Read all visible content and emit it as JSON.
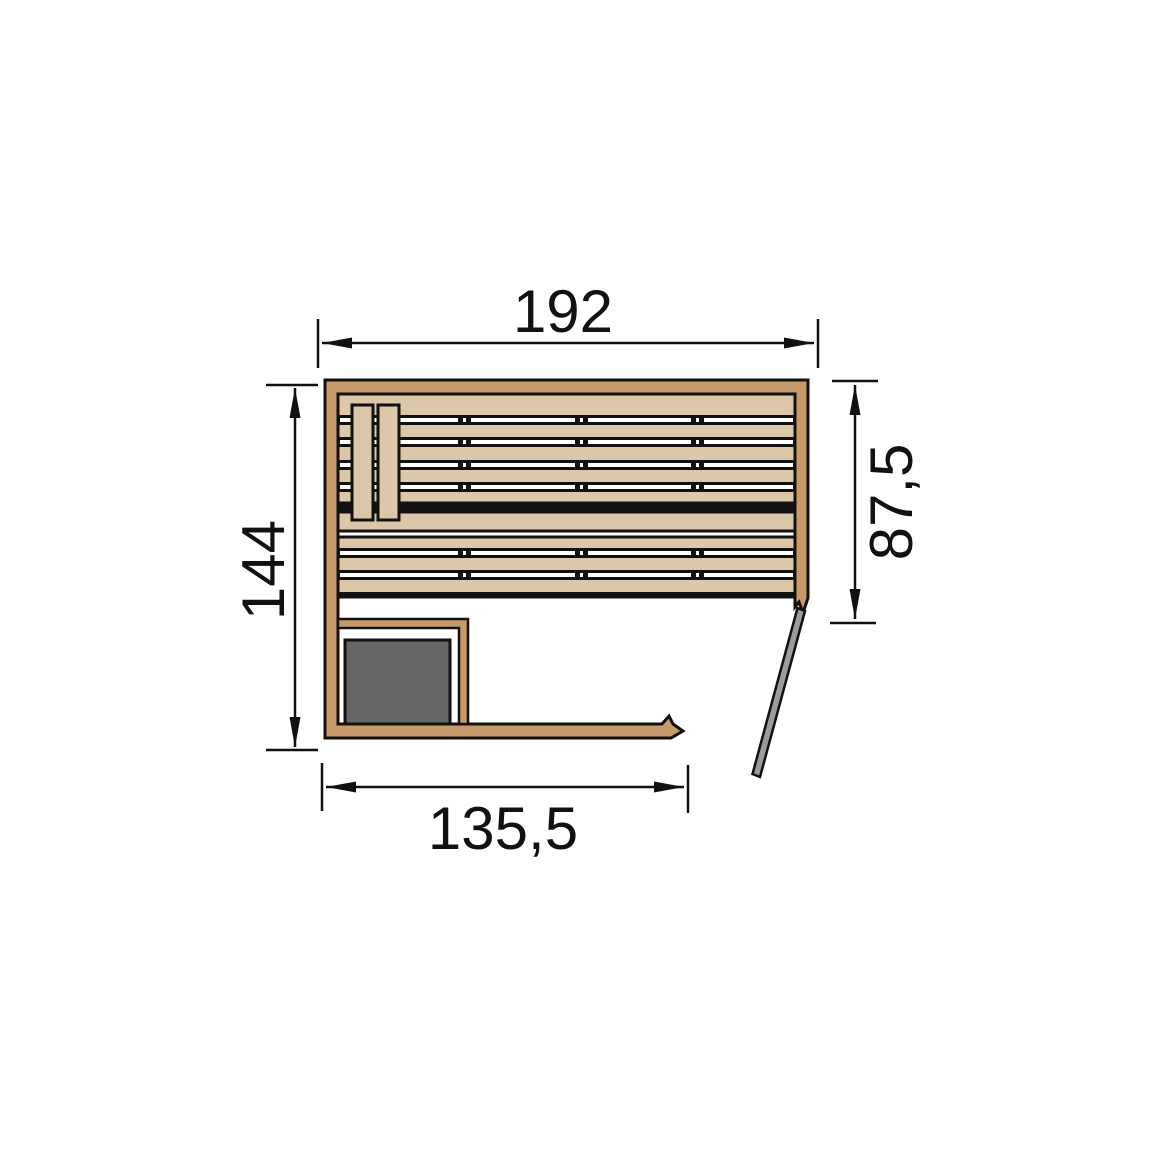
{
  "diagram": {
    "title": "sauna-floor-plan",
    "dimensions": {
      "top_width": {
        "label": "192"
      },
      "left_height": {
        "label": "144"
      },
      "right_side": {
        "label": "87,5"
      },
      "bottom_front": {
        "label": "135,5"
      }
    },
    "colors": {
      "wall": "#c69a6a",
      "bench": "#dcc7a8",
      "heater": "#666666",
      "door": "#9b9b9b",
      "line": "#111111",
      "background": "#ffffff",
      "gap_white": "#ffffff"
    }
  }
}
